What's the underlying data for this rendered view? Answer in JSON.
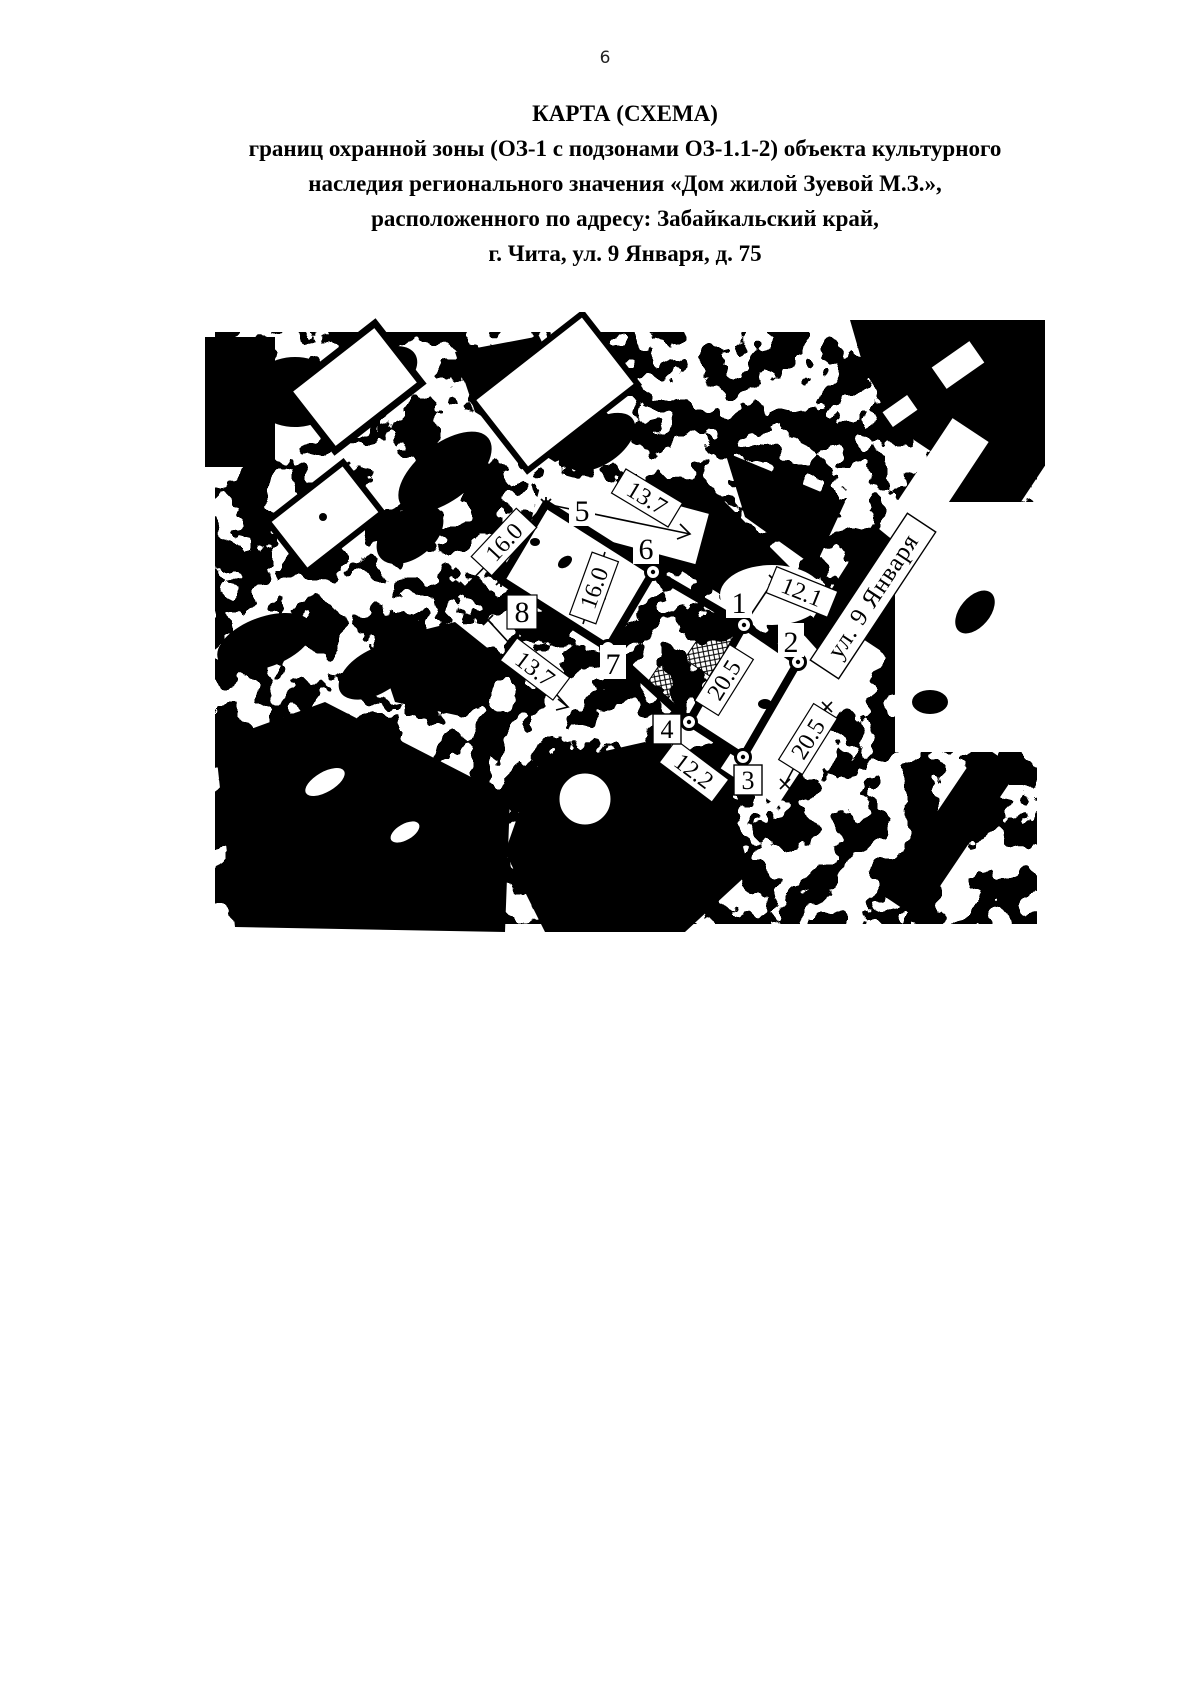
{
  "page": {
    "number": "6"
  },
  "title": {
    "line1": "КАРТА (СХЕМА)",
    "line2": "границ охранной зоны (ОЗ-1 с подзонами ОЗ-1.1-2) объекта культурного",
    "line3": "наследия регионального значения «Дом жилой Зуевой М.З.»,",
    "line4": "расположенного по адресу: Забайкальский край,",
    "line5": "г. Чита, ул. 9 Января, д. 75"
  },
  "map": {
    "street_label": "ул. 9 Января",
    "points": {
      "p1": "1",
      "p2": "2",
      "p3": "3",
      "p4": "4",
      "p5": "5",
      "p6": "6",
      "p7": "7",
      "p8": "8"
    },
    "dimensions": {
      "top_13_7": "13.7",
      "left_16_0": "16.0",
      "inner_16_0": "16.0",
      "lower_13_7": "13.7",
      "d12_1": "12.1",
      "inner_20_5": "20.5",
      "outer_20_5": "20.5",
      "d12_2": "12.2"
    },
    "colors": {
      "ink": "#000000",
      "paper": "#ffffff"
    }
  }
}
